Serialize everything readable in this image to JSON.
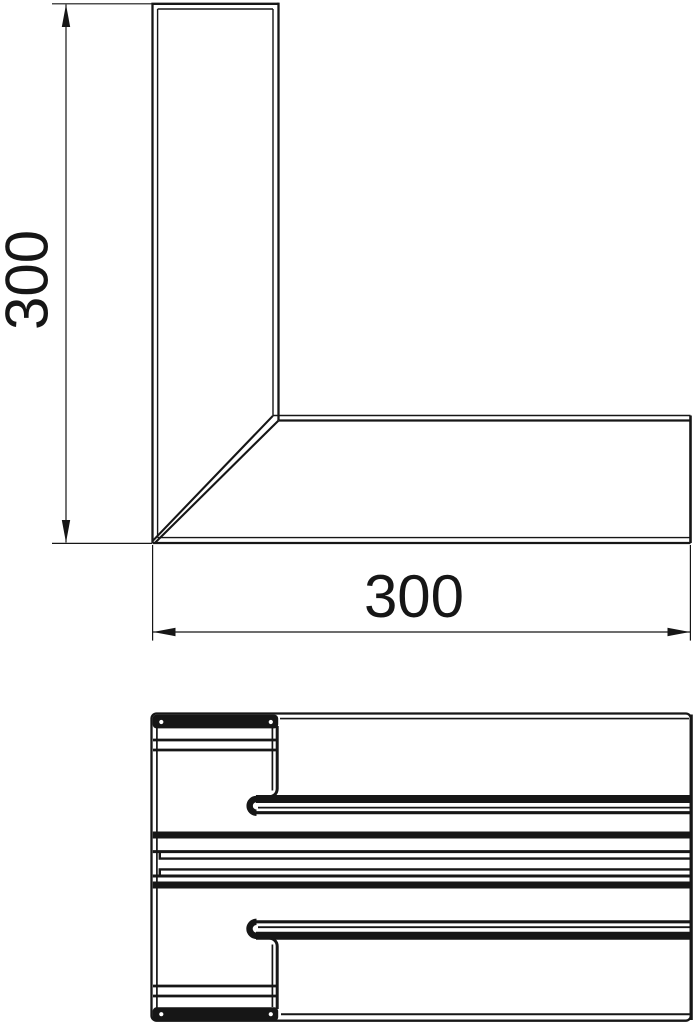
{
  "drawing": {
    "type": "technical-drawing",
    "description": "Flat corner piece of cable trunking: plan view with two dimensions and a cross-section profile below",
    "plan_view": {
      "dim_vertical_label": "300",
      "dim_horizontal_label": "300"
    },
    "section_view": {
      "label": ""
    },
    "colors": {
      "ink": "#161616",
      "background": "#ffffff"
    }
  }
}
